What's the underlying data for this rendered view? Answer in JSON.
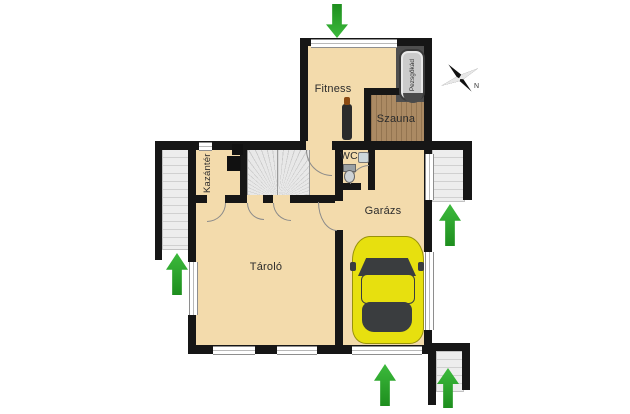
{
  "labels": {
    "fitness": "Fitness",
    "szauna": "Szauna",
    "pezsgokad": "Pezsgőkád",
    "kazanter": "Kazántér",
    "wc": "WC",
    "garazs": "Garázs",
    "tarolo": "Tároló",
    "compass_n": "N"
  },
  "arrows": [
    {
      "name": "entrance-top",
      "direction": "down"
    },
    {
      "name": "entrance-left",
      "direction": "up"
    },
    {
      "name": "entrance-right",
      "direction": "up"
    },
    {
      "name": "garage-door-bottom",
      "direction": "up"
    },
    {
      "name": "entrance-bottom-right",
      "direction": "up"
    }
  ],
  "icons": {
    "compass": "north-star",
    "toilet": "toilet-icon",
    "sink": "sink-icon",
    "boiler": "boiler-box",
    "punching_bag": "punching-bag",
    "sauna_heater": "sauna-heater",
    "car": "yellow-car-top-view"
  },
  "colors": {
    "floor": "#f3dbac",
    "wall": "#161616",
    "sauna_wood": "#ab8a63",
    "platform_dark": "#4e4e4e",
    "hot_tub": "#cbcbcb",
    "stairs": "#ededed",
    "arrow_green": "#2ca42c",
    "car_yellow": "#e7e00f",
    "car_glass_dark": "#3a3d3f"
  }
}
